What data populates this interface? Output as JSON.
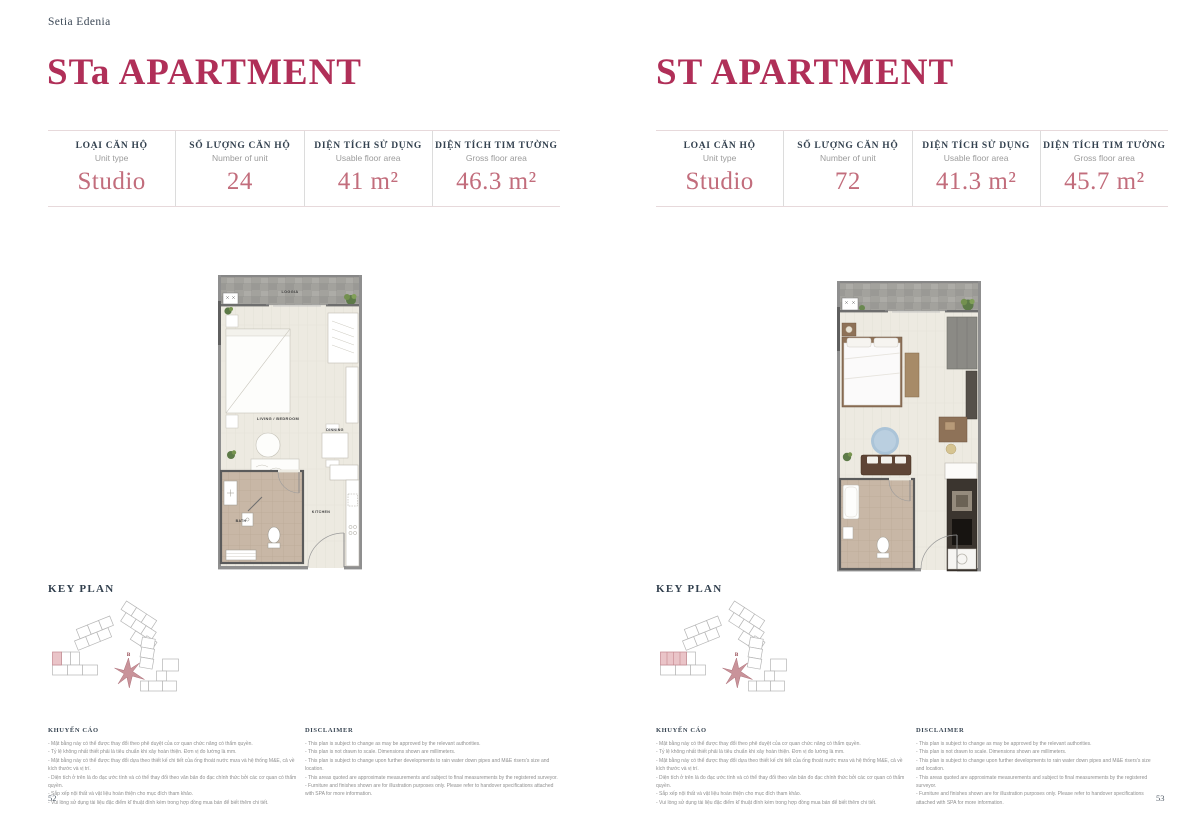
{
  "brand": "Setia Edenia",
  "key_plan_title": "KEY PLAN",
  "compass_label": "B",
  "colors": {
    "accent_title": "#b02f58",
    "value_rose": "#c26d7c",
    "heading_navy": "#33414f",
    "keyplan_highlight": "#eac4c8"
  },
  "pages": [
    {
      "title": "STa APARTMENT",
      "page_number": "52",
      "specs": [
        {
          "label_vi": "LOẠI CĂN HỘ",
          "label_en": "Unit type",
          "value": "Studio"
        },
        {
          "label_vi": "SỐ LƯỢNG CĂN HỘ",
          "label_en": "Number of unit",
          "value": "24"
        },
        {
          "label_vi": "DIỆN TÍCH SỬ DỤNG",
          "label_en": "Usable floor area",
          "value": "41 m²"
        },
        {
          "label_vi": "DIỆN TÍCH TIM TƯỜNG",
          "label_en": "Gross floor area",
          "value": "46.3 m²"
        }
      ],
      "plan_labels": {
        "loggia": "LOGGIA",
        "living": "LIVING / BEDROOM",
        "dining": "DINNING",
        "kitchen": "KITCHEN",
        "bath": "BATH"
      }
    },
    {
      "title": "ST APARTMENT",
      "page_number": "53",
      "specs": [
        {
          "label_vi": "LOẠI CĂN HỘ",
          "label_en": "Unit type",
          "value": "Studio"
        },
        {
          "label_vi": "SỐ LƯỢNG CĂN HỘ",
          "label_en": "Number of unit",
          "value": "72"
        },
        {
          "label_vi": "DIỆN TÍCH SỬ DỤNG",
          "label_en": "Usable floor area",
          "value": "41.3 m²"
        },
        {
          "label_vi": "DIỆN TÍCH TIM TƯỜNG",
          "label_en": "Gross floor area",
          "value": "45.7 m²"
        }
      ]
    }
  ],
  "disclaimer_vi": {
    "title": "KHUYẾN CÁO",
    "lines": [
      "- Mặt bằng này có thể được thay đổi theo phê duyệt của cơ quan chức năng có thẩm quyền.",
      "- Tỷ lệ không nhất thiết phải là tiêu chuẩn khi xây hoàn thiện. Đơn vị đo lường là mm.",
      "- Mặt bằng này có thể được thay đổi dựa theo thiết kế chi tiết của ống thoát nước mưa và hệ thống M&E, cả về kích thước và vị trí.",
      "- Diện tích ở trên là đo đạc ước tính và có thể thay đổi theo văn bản đo đạc chính thức bởi các cơ quan có thẩm quyền.",
      "- Sắp xếp nội thất và vật liệu hoàn thiện cho mục đích tham khảo.",
      "- Vui lòng sử dụng tài liệu đặc điểm kĩ thuật đính kèm trong hợp đồng mua bán để biết thêm chi tiết."
    ]
  },
  "disclaimer_en": {
    "title": "DISCLAIMER",
    "lines": [
      "- This plan is subject to change as may be approved by the relevant authorities.",
      "- This plan is not drawn to scale. Dimensions shown are millimeters.",
      "- This plan is subject to change upon further developments to rain water down pipes and M&E risers's size and location.",
      "- This areas quoted are approximate measurements and subject to final measurements by the registered surveyor.",
      "- Furniture and finishes shown are for illustration purposes only. Please refer to handover specifications attached with SPA for more information."
    ]
  }
}
